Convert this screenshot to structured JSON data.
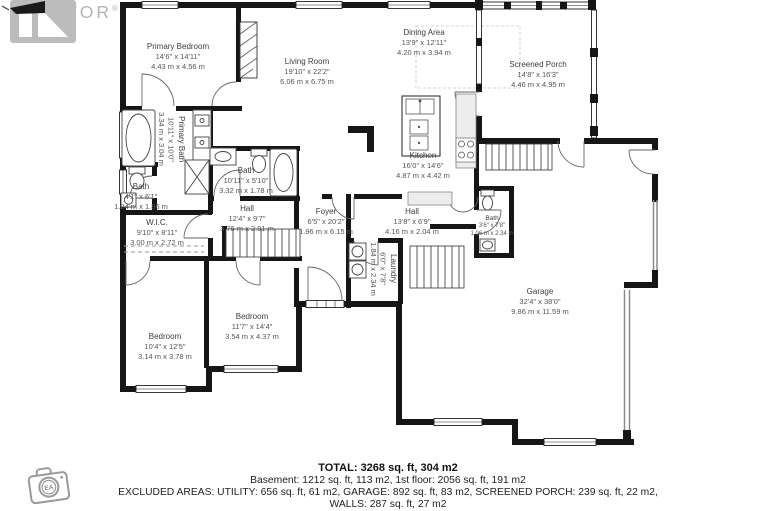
{
  "watermark": {
    "brand": "REALTOR",
    "registered": "®"
  },
  "rooms": [
    {
      "name": "Primary Bedroom",
      "imperial": "14'6\" x 14'11\"",
      "metric": "4.43 m x 4.56 m"
    },
    {
      "name": "Living Room",
      "imperial": "19'10\" x 22'2\"",
      "metric": "6.06 m x 6.75 m"
    },
    {
      "name": "Dining Area",
      "imperial": "13'9\" x 12'11\"",
      "metric": "4.20 m x 3.94 m"
    },
    {
      "name": "Screened Porch",
      "imperial": "14'8\" x 16'3\"",
      "metric": "4.46 m x 4.95 m"
    },
    {
      "name": "Kitchen",
      "imperial": "16'0\" x 14'6\"",
      "metric": "4.87 m x 4.42 m"
    },
    {
      "name": "Primary Bath",
      "imperial": "10'11\" x 10'0\"",
      "metric": "3.34 m x 3.04 m"
    },
    {
      "name": "Bath",
      "imperial": "10'11\" x 5'10\"",
      "metric": "3.32 m x 1.78 m"
    },
    {
      "name": "Bath",
      "imperial": "4'1\" x 6'1\"",
      "metric": "1.24 m x 1.86 m"
    },
    {
      "name": "W.I.C.",
      "imperial": "9'10\" x 8'11\"",
      "metric": "3.00 m x 2.72 m"
    },
    {
      "name": "Hall",
      "imperial": "12'4\" x 9'7\"",
      "metric": "3.76 m x 2.91 m"
    },
    {
      "name": "Foyer",
      "imperial": "6'5\" x 20'2\"",
      "metric": "1.96 m x 6.15 m"
    },
    {
      "name": "Hall",
      "imperial": "13'8\" x 6'9\"",
      "metric": "4.16 m x 2.04 m"
    },
    {
      "name": "Bath",
      "imperial": "3'6\" x 7'8\"",
      "metric": "1.06 m x 2.34 m"
    },
    {
      "name": "Laundry",
      "imperial": "6'0\" x 7'8\"",
      "metric": "1.84 m x 2.34 m"
    },
    {
      "name": "Bedroom",
      "imperial": "11'7\" x 14'4\"",
      "metric": "3.54 m x 4.37 m"
    },
    {
      "name": "Bedroom",
      "imperial": "10'4\" x 12'5\"",
      "metric": "3.14 m x 3.78 m"
    },
    {
      "name": "Garage",
      "imperial": "32'4\" x 38'0\"",
      "metric": "9.86 m x 11.59 m"
    }
  ],
  "summary": {
    "total": "TOTAL: 3268 sq. ft, 304 m2",
    "floors": "Basement: 1212 sq. ft, 113 m2, 1st floor: 2056 sq. ft, 191 m2",
    "excluded": "EXCLUDED AREAS: UTILITY: 656 sq. ft, 61 m2, GARAGE: 892 sq. ft, 83 m2, SCREENED PORCH: 239 sq. ft, 22 m2,",
    "walls": "WALLS: 287 sq. ft, 27 m2"
  },
  "badges": {
    "camera_initials": "EA"
  }
}
